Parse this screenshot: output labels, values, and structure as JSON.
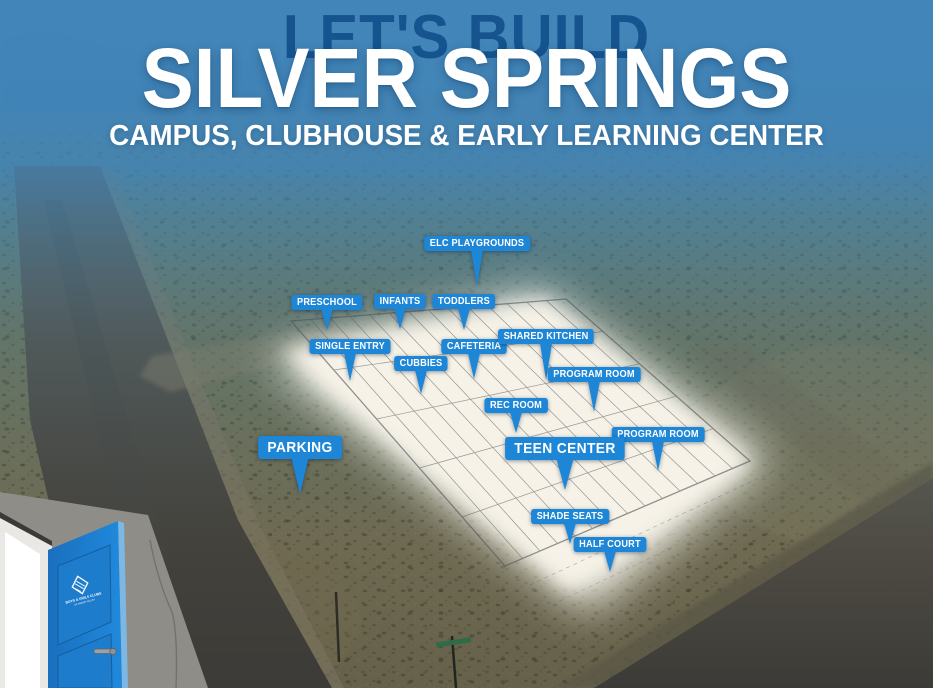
{
  "header": {
    "kicker": "LET'S BUILD",
    "title": "SILVER SPRINGS",
    "subtitle": "CAMPUS, CLUBHOUSE & EARLY LEARNING CENTER"
  },
  "map_labels": [
    {
      "id": "elc-playgrounds",
      "text": "ELC PLAYGROUNDS",
      "cx": 477,
      "y": 236,
      "tail": 36,
      "size": "small"
    },
    {
      "id": "preschool",
      "text": "PRESCHOOL",
      "cx": 327,
      "y": 295,
      "tail": 21,
      "size": "small"
    },
    {
      "id": "infants",
      "text": "INFANTS",
      "cx": 400,
      "y": 294,
      "tail": 21,
      "size": "small"
    },
    {
      "id": "toddlers",
      "text": "TODDLERS",
      "cx": 464,
      "y": 294,
      "tail": 22,
      "size": "small"
    },
    {
      "id": "single-entry",
      "text": "SINGLE ENTRY",
      "cx": 350,
      "y": 339,
      "tail": 28,
      "size": "small"
    },
    {
      "id": "cafeteria",
      "text": "CAFETERIA",
      "cx": 474,
      "y": 339,
      "tail": 26,
      "size": "small"
    },
    {
      "id": "shared-kitchen",
      "text": "SHARED KITCHEN",
      "cx": 546,
      "y": 329,
      "tail": 37,
      "size": "small"
    },
    {
      "id": "cubbies",
      "text": "CUBBIES",
      "cx": 421,
      "y": 356,
      "tail": 24,
      "size": "small"
    },
    {
      "id": "program-room-1",
      "text": "PROGRAM ROOM",
      "cx": 594,
      "y": 367,
      "tail": 31,
      "size": "small"
    },
    {
      "id": "rec-room",
      "text": "REC ROOM",
      "cx": 516,
      "y": 398,
      "tail": 21,
      "size": "small"
    },
    {
      "id": "program-room-2",
      "text": "PROGRAM ROOM",
      "cx": 658,
      "y": 427,
      "tail": 30,
      "size": "small"
    },
    {
      "id": "teen-center",
      "text": "TEEN CENTER",
      "cx": 565,
      "y": 437,
      "tail": 31,
      "size": "large"
    },
    {
      "id": "parking",
      "text": "PARKING",
      "cx": 300,
      "y": 436,
      "tail": 36,
      "size": "large"
    },
    {
      "id": "shade-seats",
      "text": "SHADE SEATS",
      "cx": 570,
      "y": 509,
      "tail": 21,
      "size": "small"
    },
    {
      "id": "half-court",
      "text": "HALF COURT",
      "cx": 610,
      "y": 537,
      "tail": 21,
      "size": "small"
    }
  ],
  "door_logo": {
    "icon": "boys-girls-clubs-hands-mark",
    "org": "BOYS & GIRLS CLUBS",
    "chapter": "OF MASON VALLEY"
  },
  "colors": {
    "label_blue": "#1d86d6",
    "kicker_navy": "#15548f",
    "door_blue": "#1e82d6",
    "sky_haze_blue": "#4286ba",
    "title_white": "#ffffff"
  }
}
